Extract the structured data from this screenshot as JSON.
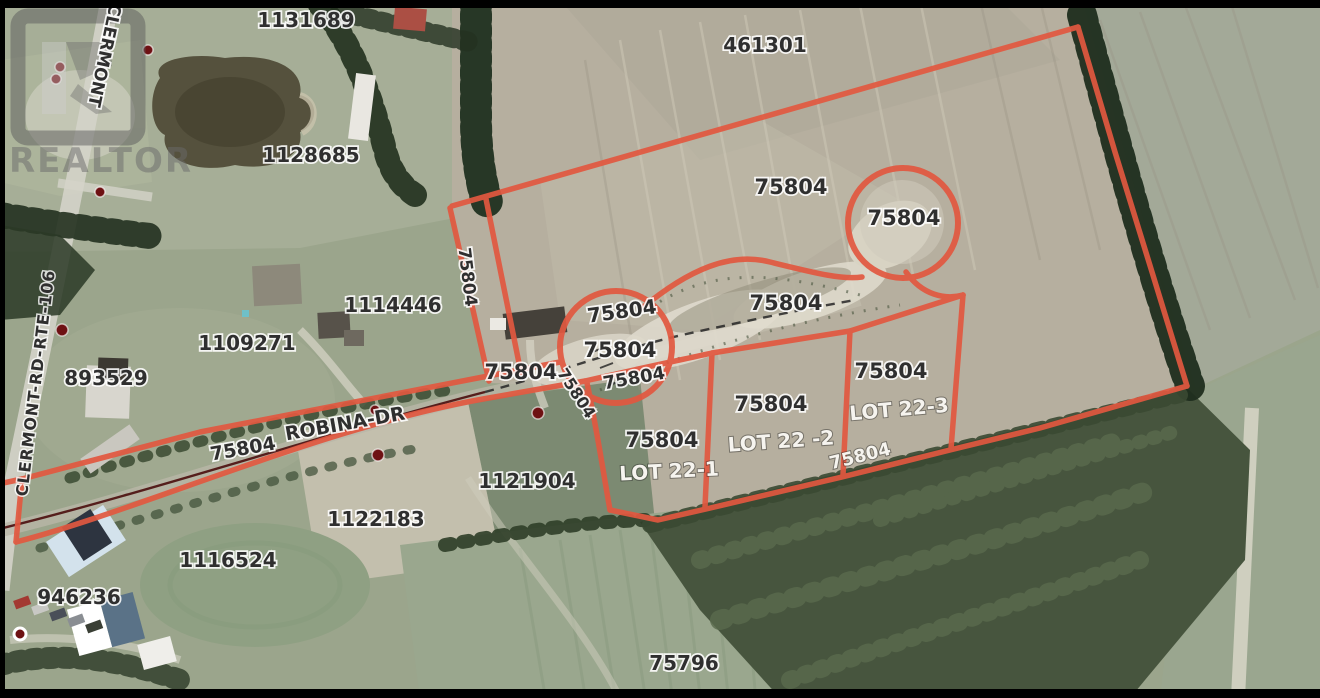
{
  "map": {
    "type": "aerial-parcel-map",
    "watermark": "REALTOR",
    "palette": {
      "boundary_color": "#e25840",
      "survey_dot_color": "#6e1113",
      "centerline_color": "#4a0d0d",
      "parcel_label_color": "#2f2f2f",
      "lot_label_color": "#f6f4ef"
    },
    "labels": [
      {
        "name": "road-clermont-top",
        "text": "CLERMONT"
      },
      {
        "name": "parcel-1131689",
        "text": "1131689"
      },
      {
        "name": "parcel-1128685",
        "text": "1128685"
      },
      {
        "name": "parcel-461301",
        "text": "461301"
      },
      {
        "name": "pid-75804-upper-field",
        "text": "75804"
      },
      {
        "name": "pid-75804-balloon",
        "text": "75804"
      },
      {
        "name": "pid-75804-pit",
        "text": "75804"
      },
      {
        "name": "pid-75804-circle-top",
        "text": "75804"
      },
      {
        "name": "pid-75804-circle-mid",
        "text": "75804"
      },
      {
        "name": "pid-75804-circle-low",
        "text": "75804"
      },
      {
        "name": "pid-75804-west",
        "text": "75804"
      },
      {
        "name": "pid-75804-strip-vertical",
        "text": "75804"
      },
      {
        "name": "pid-75804-diagonal",
        "text": "75804"
      },
      {
        "name": "pid-75804-lot1",
        "text": "75804"
      },
      {
        "name": "lot-22-1",
        "text": "LOT 22-1"
      },
      {
        "name": "pid-75804-lot2",
        "text": "75804"
      },
      {
        "name": "lot-22-2",
        "text": "LOT 22 -2"
      },
      {
        "name": "pid-75804-lot3",
        "text": "75804"
      },
      {
        "name": "lot-22-3",
        "text": "LOT 22-3"
      },
      {
        "name": "pid-75804-forest-edge",
        "text": "75804"
      },
      {
        "name": "parcel-1114446",
        "text": "1114446"
      },
      {
        "name": "parcel-1109271",
        "text": "1109271"
      },
      {
        "name": "parcel-893529",
        "text": "893529"
      },
      {
        "name": "pid-75804-robina",
        "text": "75804"
      },
      {
        "name": "road-robina-dr",
        "text": "ROBINA-DR"
      },
      {
        "name": "parcel-1121904",
        "text": "1121904"
      },
      {
        "name": "parcel-1122183",
        "text": "1122183"
      },
      {
        "name": "parcel-1116524",
        "text": "1116524"
      },
      {
        "name": "parcel-946236",
        "text": "946236"
      },
      {
        "name": "parcel-75796",
        "text": "75796"
      },
      {
        "name": "road-clermont-rte-106",
        "text": "CLERMONT-RD-RTE-106"
      }
    ]
  }
}
